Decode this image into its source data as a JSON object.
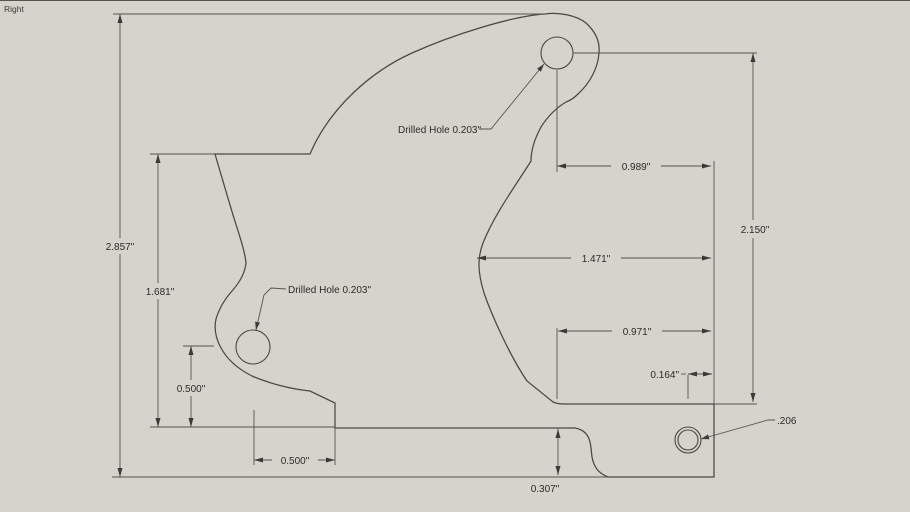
{
  "scene": {
    "label": "Right"
  },
  "colors": {
    "background": "#d6d3cc",
    "edge_line": "#4a4843",
    "dimension_line": "#55534e",
    "text": "#2d2b27"
  },
  "dimensions": {
    "overall_height": "2.857\"",
    "left_profile_height": "1.681\"",
    "hole_center_height": "0.500\"",
    "hole_center_offset": "0.500\"",
    "step_height": "0.307\"",
    "hole_to_right_edge": "0.989\"",
    "arc_to_right_edge": "1.471\"",
    "notch_to_right_edge": "0.971\"",
    "small_hole_to_edge": "0.164\"",
    "right_side_height": "2.150\""
  },
  "leaders": {
    "top_hole": "Drilled Hole 0.203\"",
    "lower_hole": "Drilled Hole 0.203\"",
    "small_hole": ".206"
  }
}
